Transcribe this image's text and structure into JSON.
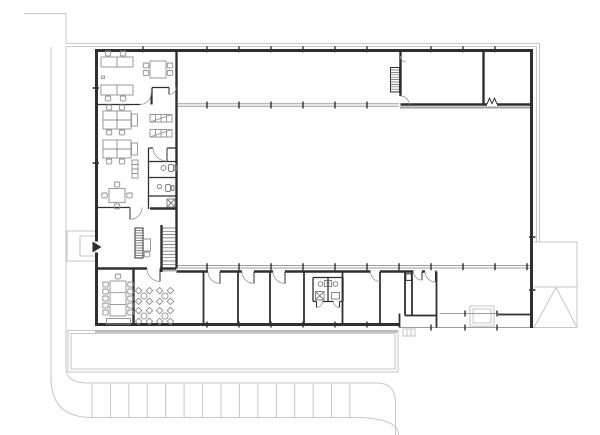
{
  "plan": {
    "type": "architectural-floor-plan",
    "storeys_shown": 1,
    "column_grid": {
      "tick_spacing_px": 32,
      "tick_xs": [
        143,
        207,
        239,
        271,
        303,
        335,
        367,
        399,
        431,
        463,
        495,
        527
      ]
    },
    "areas": [
      {
        "name": "open-office-top",
        "furniture": {
          "double_desks": 2,
          "desk_chairs": 4,
          "meeting_table_seats": 4
        }
      },
      {
        "name": "open-office-middle",
        "furniture": {
          "desk_clusters": 2,
          "desk_chairs": 8,
          "side_tables": 2,
          "shelving_units": 2,
          "tall_cabinet": 1
        }
      },
      {
        "name": "wc-rooms-office-strip",
        "count": 3
      },
      {
        "name": "office-meeting-small",
        "furniture": {
          "square_table_seats": 4
        }
      },
      {
        "name": "entrance-hall",
        "furniture": {
          "reception_desk": 1,
          "locker_unit": 1,
          "main_stair": 1
        },
        "entrance_arrow": 1
      },
      {
        "name": "conference-room",
        "furniture": {
          "long_table": 1,
          "chairs": 11,
          "sideboard": 1
        }
      },
      {
        "name": "break-room",
        "furniture": {
          "table_clusters": 4
        }
      },
      {
        "name": "main-hall",
        "open_space": true
      },
      {
        "name": "top-right-rooms",
        "count": 2,
        "stair": 1,
        "double_door": 1
      },
      {
        "name": "bottom-room-band",
        "rooms": 7,
        "wc_block_cubicles": 2,
        "door_arcs": 6
      },
      {
        "name": "loading-dock-recess",
        "dock_pad": 1,
        "ramp_triangle": 1
      }
    ],
    "site": {
      "parking_stall_dividers": 15,
      "terrace": 1,
      "entrance_porch": 1,
      "curved_curbs": 2
    },
    "stairs_total": 2
  },
  "colors": {
    "wall": "#2f2f2f",
    "band": "#9c9c9c",
    "furniture": "#8f8f8f",
    "door": "#a0a0a0",
    "site": "#c6c6c6",
    "hatch": "#606060",
    "fixture": "#7a7a7a",
    "background": "#ffffff"
  }
}
